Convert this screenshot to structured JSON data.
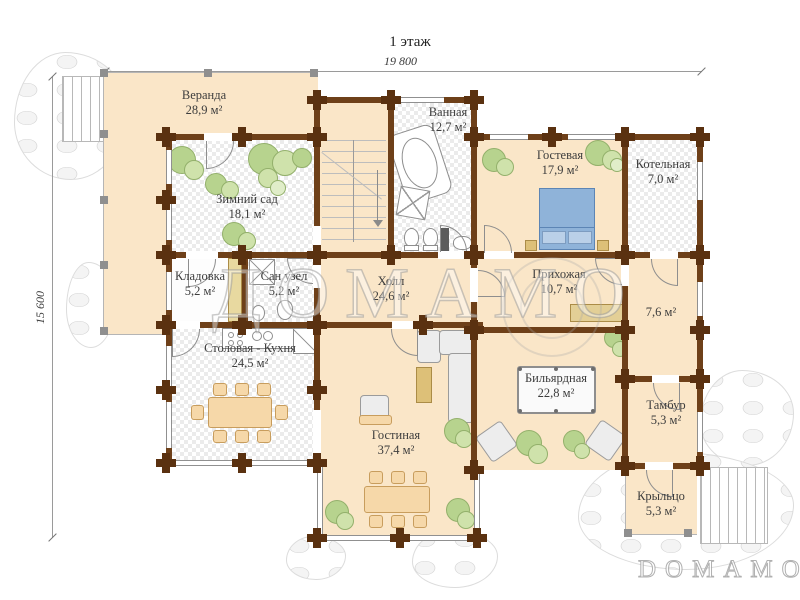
{
  "title": "1 этаж",
  "dimensions": {
    "top": "19 800",
    "left": "15 600"
  },
  "watermark": {
    "center": "ДОМАМО",
    "bottom_right": "DOMAMO"
  },
  "rooms": [
    {
      "name": "Веранда",
      "area": "28,9 м²"
    },
    {
      "name": "Зимний сад",
      "area": "18,1 м²"
    },
    {
      "name": "Ванная",
      "area": "12,7 м²"
    },
    {
      "name": "Гостевая",
      "area": "17,9 м²"
    },
    {
      "name": "Котельная",
      "area": "7,0 м²"
    },
    {
      "name": "Кладовка",
      "area": "5,2 м²"
    },
    {
      "name": "Сан узел",
      "area": "5,2 м²"
    },
    {
      "name": "Холл",
      "area": "24,6 м²"
    },
    {
      "name": "Прихожая",
      "area": "10,7 м²"
    },
    {
      "name": "",
      "area": "7,6 м²"
    },
    {
      "name": "Столовая - Кухня",
      "area": "24,5 м²"
    },
    {
      "name": "Бильярдная",
      "area": "22,8 м²"
    },
    {
      "name": "Гостиная",
      "area": "37,4 м²"
    },
    {
      "name": "Тамбур",
      "area": "5,3 м²"
    },
    {
      "name": "Крыльцо",
      "area": "5,3 м²"
    }
  ],
  "colors": {
    "wall": "#6e4019",
    "post": "#5a3110",
    "floor_beige": "#fae6c8",
    "plant_green": "#b7d38e",
    "bed_blue": "#8fb3d9",
    "furniture_tan": "#f6d8a9"
  }
}
